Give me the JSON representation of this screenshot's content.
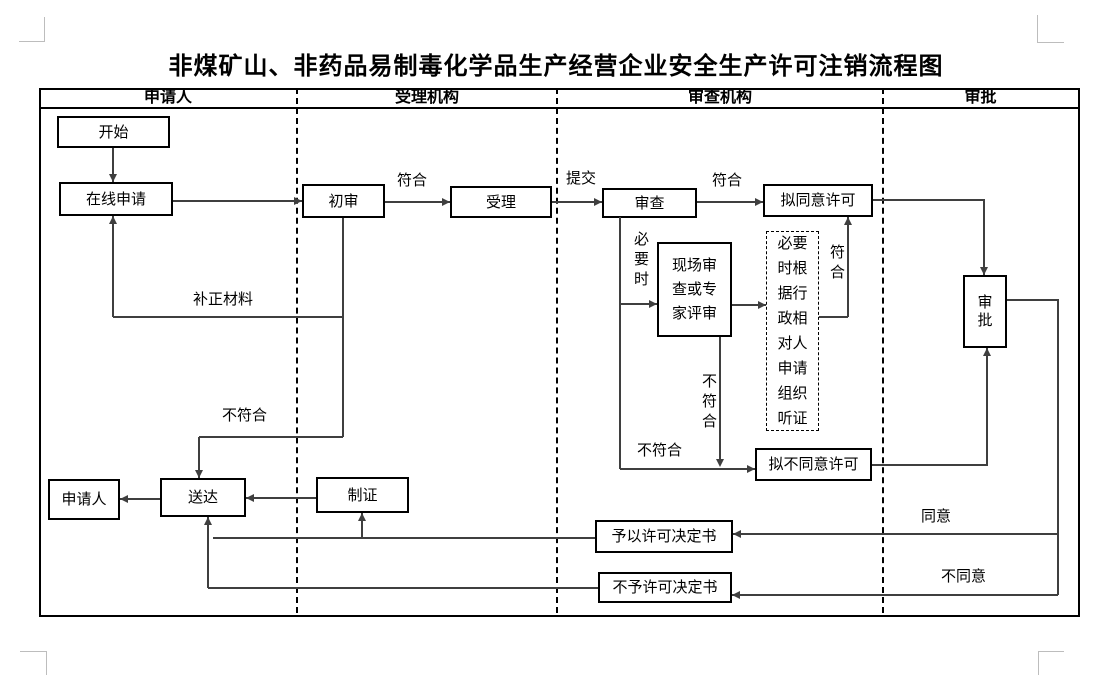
{
  "title": "非煤矿山、非药品易制毒化学品生产经营企业安全生产许可注销流程图",
  "lanes": {
    "applicant": "申请人",
    "acceptor": "受理机构",
    "reviewer": "审查机构",
    "approver": "审批"
  },
  "nodes": {
    "start": "开始",
    "online_apply": "在线申请",
    "preliminary_review": "初审",
    "accept": "受理",
    "review": "审查",
    "proposed_approval": "拟同意许可",
    "site_or_expert_review": "现场审查或专家评审",
    "hearing_note": "必要时根据行政相对人申请组织听证",
    "proposed_denial": "拟不同意许可",
    "approval": "审批",
    "grant_decision": "予以许可决定书",
    "denial_decision": "不予许可决定书",
    "make_certificate": "制证",
    "deliver": "送达",
    "applicant_end": "申请人"
  },
  "edge_labels": {
    "conform_preliminary": "符合",
    "submit": "提交",
    "conform_review": "符合",
    "when_necessary": "必要时",
    "conform_hearing": "符合",
    "not_conform_site": "不符合",
    "not_conform_review": "不符合",
    "supplement_materials": "补正材料",
    "not_conform_preliminary": "不符合",
    "agree": "同意",
    "disagree": "不同意"
  },
  "colors": {
    "line": "#3f3f3f",
    "border": "#000000",
    "corner_mark": "#bdbdbd",
    "background": "#ffffff"
  }
}
